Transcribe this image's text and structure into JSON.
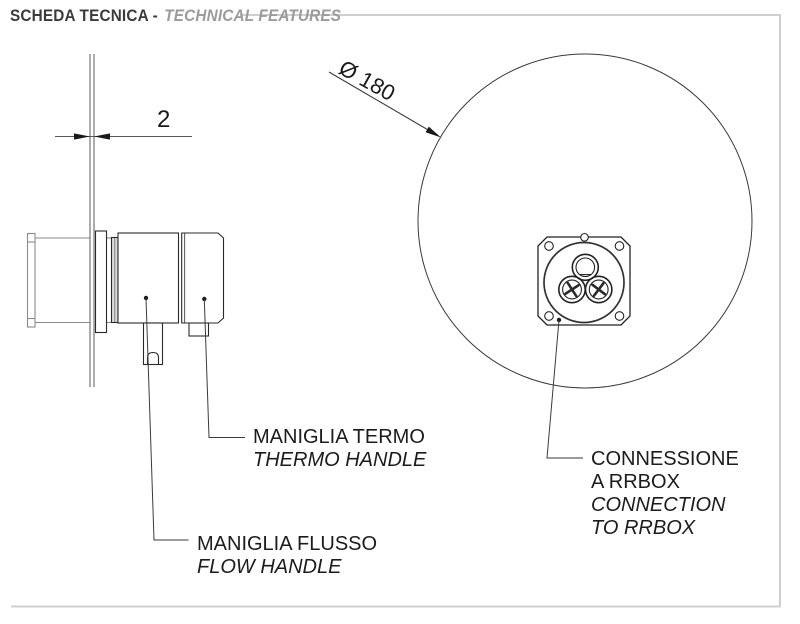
{
  "header": {
    "title_it": "SCHEDA TECNICA -",
    "title_en": "TECHNICAL FEATURES"
  },
  "side_view": {
    "wall_thickness_dimension": "2",
    "thermo_handle_label_it": "MANIGLIA TERMO",
    "thermo_handle_label_en": "THERMO HANDLE",
    "flow_handle_label_it": "MANIGLIA FLUSSO",
    "flow_handle_label_en": "FLOW HANDLE"
  },
  "front_view": {
    "diameter_dimension": "Ø 180",
    "connection_label_it_line1": "CONNESSIONE",
    "connection_label_it_line2": "A RRBOX",
    "connection_label_en_line1": "CONNECTION",
    "connection_label_en_line2": "TO RRBOX"
  },
  "colors": {
    "line_dark": "#2a2a2a",
    "line_gray_hidden": "#8a8a8a",
    "frame_gray": "#cfcfcf",
    "header_dark": "#3b3b3b",
    "header_gray": "#9b9b9b",
    "background": "#ffffff"
  }
}
